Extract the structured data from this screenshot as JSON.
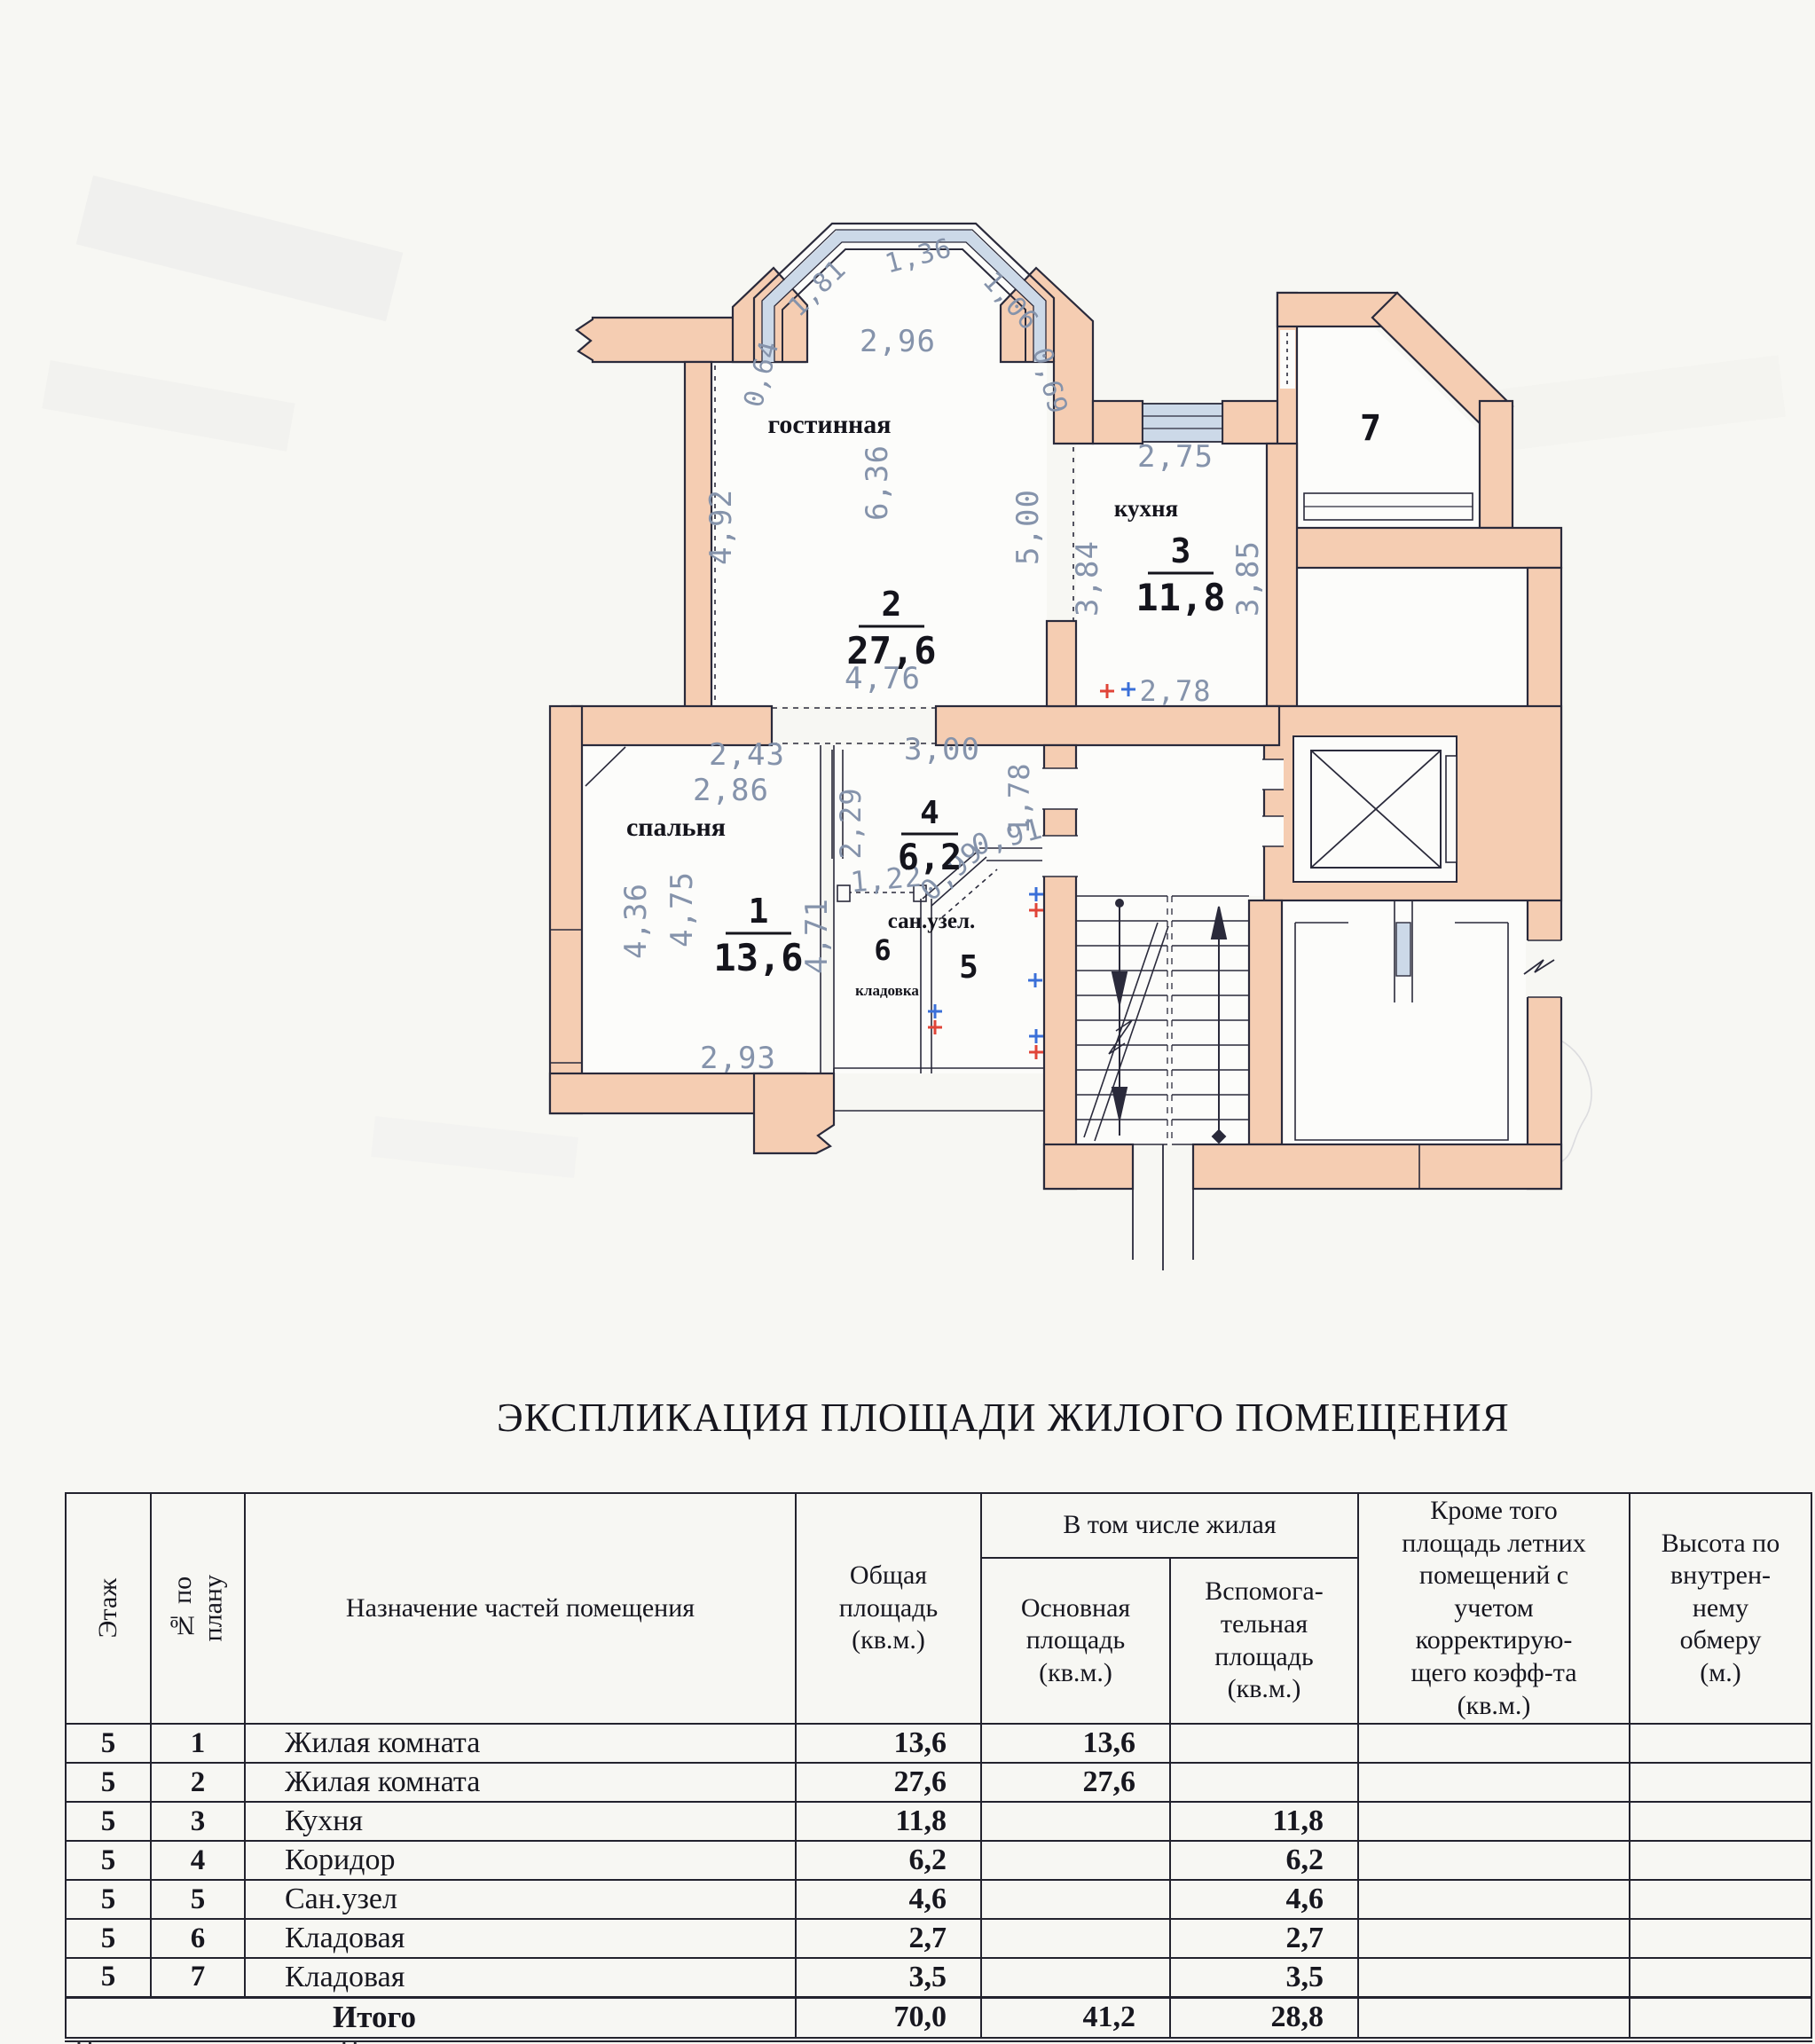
{
  "plan": {
    "rooms": {
      "living": {
        "label": "гостинная",
        "number": "2",
        "area": "27,6"
      },
      "kitchen": {
        "label": "кухня",
        "number": "3",
        "area": "11,8"
      },
      "bedroom": {
        "label": "спальня",
        "number": "1",
        "area": "13,6"
      },
      "hall": {
        "number": "4",
        "area": "6,2"
      },
      "san": {
        "label": "сан.узел.",
        "number": "5"
      },
      "storage6": {
        "label": "кладовка",
        "number": "6"
      },
      "storage7": {
        "number": "7"
      }
    },
    "dims": {
      "bay1": "0,64",
      "bay2": "1,81",
      "bay3": "1,36",
      "bay4": "1,06",
      "bay5": "0,69",
      "bay_w": "2,96",
      "liv_left": "4,92",
      "liv_h": "6,36",
      "liv_right": "5,00",
      "kit_top": "2,75",
      "kit_left": "3,84",
      "kit_right": "3,85",
      "kit_bot": "2,78",
      "open_liv": "4,76",
      "hall_w": "3,00",
      "hall_left": "2,29",
      "stair_left": "1,78",
      "san_d1": "0,99",
      "san_d2": "0,91",
      "store_door": "1,22",
      "bed_t1": "2,43",
      "bed_t2": "2,86",
      "bed_l1": "4,36",
      "bed_l2": "4,75",
      "bed_r": "4,71",
      "bed_b": "2,93"
    },
    "colors": {
      "wall": "#f5cdb2",
      "window": "#ccd9e8",
      "dim_text": "#8593ab",
      "plus_red": "#e04438",
      "plus_blue": "#3a6fd8"
    }
  },
  "table": {
    "title": "ЭКСПЛИКАЦИЯ ПЛОЩАДИ ЖИЛОГО ПОМЕЩЕНИЯ",
    "headers": {
      "floor": "Этаж",
      "plan_no": "№ по\nплану",
      "purpose": "Назначение частей помещения",
      "total": "Общая\nплощадь\n(кв.м.)",
      "incl": "В том числе жилая",
      "main": "Основная\nплощадь\n(кв.м.)",
      "aux": "Вспомога-\nтельная\nплощадь\n(кв.м.)",
      "summer": "Кроме того\nплощадь летних\nпомещений с\nучетом\nкорректирую-\nщего коэфф-та\n(кв.м.)",
      "height": "Высота по\nвнутрен-\nнему\nобмеру\n(м.)"
    },
    "rows": [
      {
        "floor": "5",
        "no": "1",
        "purpose": "Жилая комната",
        "total": "13,6",
        "main": "13,6",
        "aux": "",
        "summer": "",
        "height": ""
      },
      {
        "floor": "5",
        "no": "2",
        "purpose": "Жилая комната",
        "total": "27,6",
        "main": "27,6",
        "aux": "",
        "summer": "",
        "height": ""
      },
      {
        "floor": "5",
        "no": "3",
        "purpose": "Кухня",
        "total": "11,8",
        "main": "",
        "aux": "11,8",
        "summer": "",
        "height": ""
      },
      {
        "floor": "5",
        "no": "4",
        "purpose": "Коридор",
        "total": "6,2",
        "main": "",
        "aux": "6,2",
        "summer": "",
        "height": ""
      },
      {
        "floor": "5",
        "no": "5",
        "purpose": "Сан.узел",
        "total": "4,6",
        "main": "",
        "aux": "4,6",
        "summer": "",
        "height": ""
      },
      {
        "floor": "5",
        "no": "6",
        "purpose": "Кладовая",
        "total": "2,7",
        "main": "",
        "aux": "2,7",
        "summer": "",
        "height": ""
      },
      {
        "floor": "5",
        "no": "7",
        "purpose": "Кладовая",
        "total": "3,5",
        "main": "",
        "aux": "3,5",
        "summer": "",
        "height": ""
      }
    ],
    "total_row": {
      "label": "Итого",
      "total": "70,0",
      "main": "41,2",
      "aux": "28,8"
    }
  },
  "scan": {
    "footer_fragment": "Примечание. Площадь"
  }
}
